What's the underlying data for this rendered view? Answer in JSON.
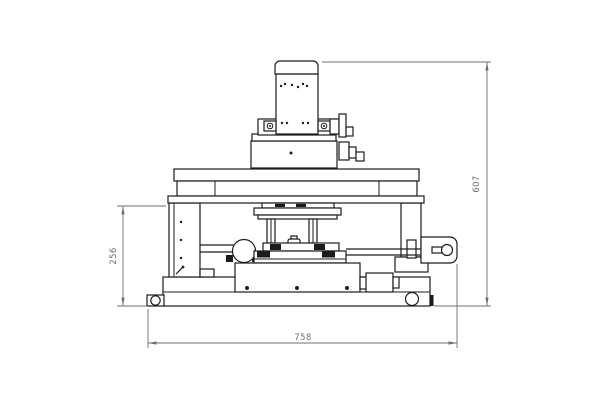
{
  "drawing": {
    "subject": "front-elevation technical drawing of benchtop measuring machine",
    "colors": {
      "bg": "#ffffff",
      "line": "#1c1c1c",
      "dim": "#6f6f6f"
    }
  },
  "dims": {
    "overall_height": {
      "value": "607"
    },
    "working_height": {
      "value": "256"
    },
    "base_width": {
      "value": "758"
    }
  }
}
